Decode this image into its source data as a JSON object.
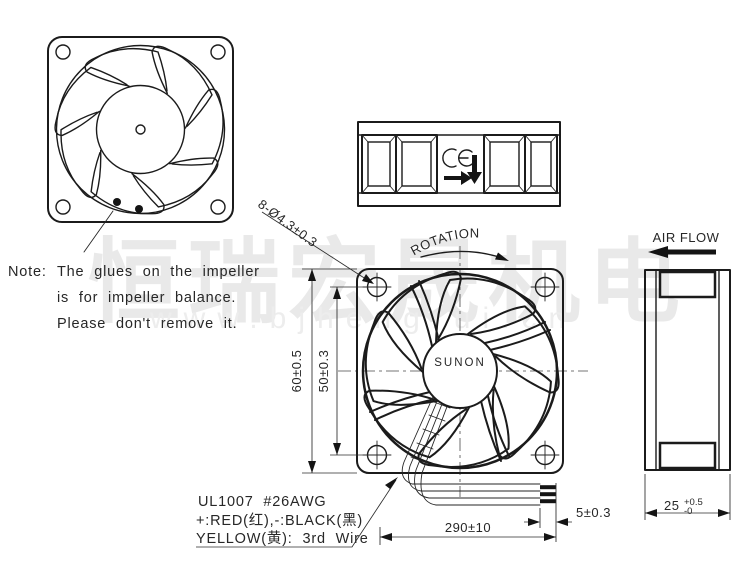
{
  "watermark": {
    "company_cn": "恒瑞宏晟机电",
    "website": "www.bjhengrui.cn"
  },
  "note": {
    "label": "Note:",
    "line1": "The glues on the impeller",
    "line2": "is for impeller balance.",
    "line3": "Please don't remove it."
  },
  "drawing": {
    "mounting_holes": "8-Ø4.3±0.3",
    "rotation": "ROTATION",
    "airflow": "AIR FLOW",
    "brand": "SUNON",
    "ce_mark": "CE"
  },
  "dims": {
    "frame": "60±0.5",
    "hole_pitch": "50±0.3",
    "depth": "25",
    "depth_tol_plus": "+0.5",
    "depth_tol_minus": "-0",
    "lead_length": "290±10",
    "strip_length": "5±0.3"
  },
  "wires": {
    "spec": "UL1007 #26AWG",
    "polarity": "+:RED(红),-:BLACK(黑)",
    "third": "YELLOW(黄): 3rd Wire"
  }
}
